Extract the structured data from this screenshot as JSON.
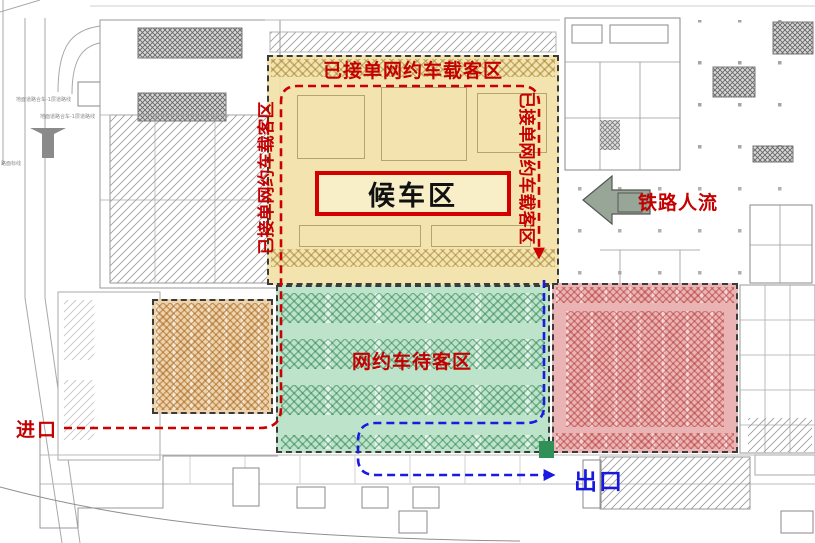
{
  "diagram": {
    "kind": "station-floor-plan",
    "colors": {
      "accent_red": "#c40000",
      "accent_blue": "#1717dd",
      "zone_pickup_fill": "#f2e2a8",
      "zone_queue_fill": "#b7e1c6",
      "zone_west_fill": "#edd0a8",
      "zone_east_fill": "#e9aeae",
      "hall_border": "#d40000",
      "rail_arrow_fill": "#97a697"
    }
  },
  "zones": {
    "pickup": {
      "label": "已接单网约车载客区"
    },
    "waiting_hall": {
      "label": "候车区"
    },
    "queue": {
      "label": "网约车待客区"
    },
    "west_parking": {
      "label": ""
    },
    "east_parking": {
      "label": ""
    }
  },
  "annotations": {
    "rail_flow": "铁路人流",
    "entrance": "进口",
    "exit": "出口"
  },
  "roads": {
    "label1": "地面道路合车-1层道路线",
    "label2": "地面道路合车-1层道路线",
    "label3": "路面标线"
  }
}
